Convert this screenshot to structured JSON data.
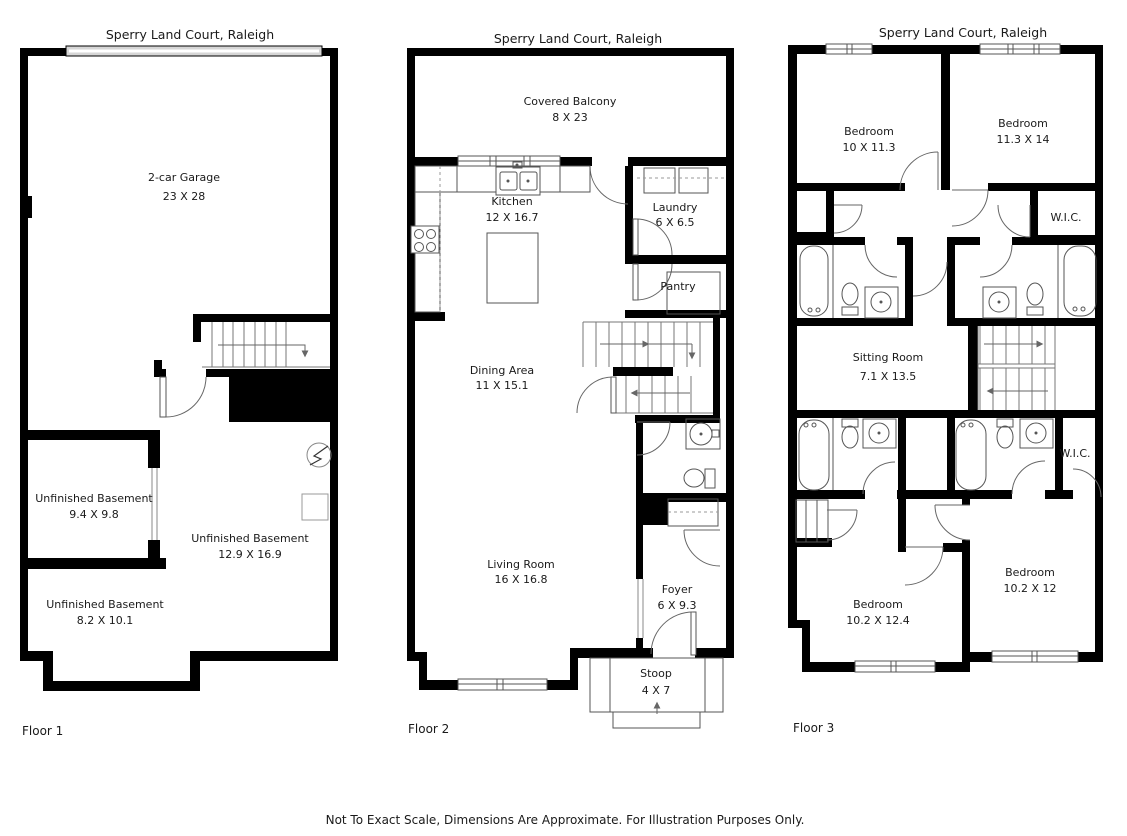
{
  "palette": {
    "wall": "#000000",
    "garage_door_fill": "#d6d6d6",
    "line": "#555555",
    "text": "#1a1a1a"
  },
  "disclaimer": "Not To Exact Scale, Dimensions Are Approximate. For Illustration Purposes Only.",
  "floor1": {
    "title": "Sperry Land Court, Raleigh",
    "caption": "Floor 1",
    "rooms": {
      "garage": {
        "name": "2-car Garage",
        "dims": "23 X 28"
      },
      "basement_small": {
        "name": "Unfinished Basement",
        "dims": "9.4 X 9.8"
      },
      "basement_main": {
        "name": "Unfinished Basement",
        "dims": "12.9 X 16.9"
      },
      "basement_lower": {
        "name": "Unfinished Basement",
        "dims": "8.2 X 10.1"
      }
    }
  },
  "floor2": {
    "title": "Sperry Land Court, Raleigh",
    "caption": "Floor 2",
    "rooms": {
      "balcony": {
        "name": "Covered Balcony",
        "dims": "8 X 23"
      },
      "kitchen": {
        "name": "Kitchen",
        "dims": "12 X 16.7"
      },
      "laundry": {
        "name": "Laundry",
        "dims": "6 X 6.5"
      },
      "pantry": {
        "name": "Pantry"
      },
      "dining": {
        "name": "Dining Area",
        "dims": "11 X 15.1"
      },
      "living": {
        "name": "Living Room",
        "dims": "16 X 16.8"
      },
      "foyer": {
        "name": "Foyer",
        "dims": "6 X 9.3"
      },
      "stoop": {
        "name": "Stoop",
        "dims": "4 X 7"
      }
    }
  },
  "floor3": {
    "title": "Sperry Land Court, Raleigh",
    "caption": "Floor 3",
    "rooms": {
      "bedroom_top_left": {
        "name": "Bedroom",
        "dims": "10 X 11.3"
      },
      "bedroom_top_right": {
        "name": "Bedroom",
        "dims": "11.3 X 14"
      },
      "wic_upper": {
        "name": "W.I.C."
      },
      "sitting": {
        "name": "Sitting Room",
        "dims": "7.1 X 13.5"
      },
      "wic_lower": {
        "name": "W.I.C."
      },
      "bedroom_bottom_left": {
        "name": "Bedroom",
        "dims": "10.2 X 12.4"
      },
      "bedroom_bottom_right": {
        "name": "Bedroom",
        "dims": "10.2 X 12"
      }
    }
  }
}
